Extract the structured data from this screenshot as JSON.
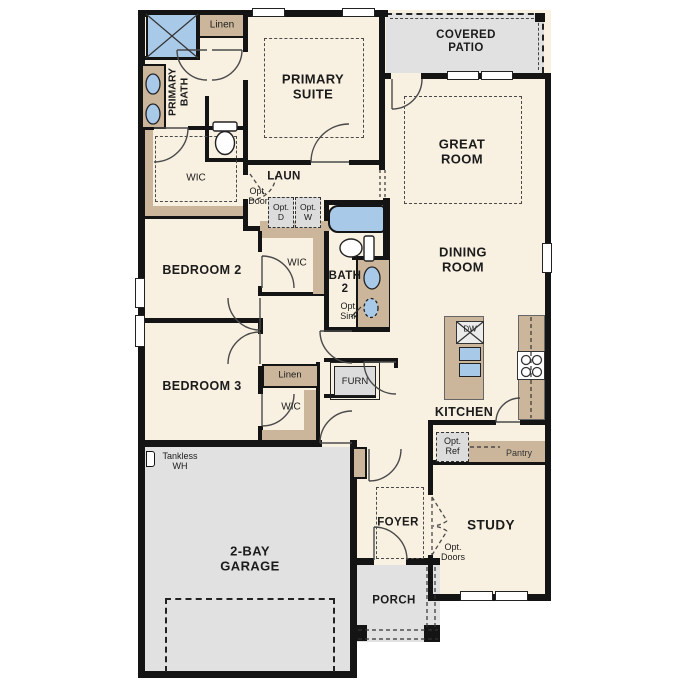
{
  "labels": {
    "covered_patio": "COVERED\nPATIO",
    "primary_suite": "PRIMARY\nSUITE",
    "primary_bath": "PRIMARY\nBATH",
    "linen_top": "Linen",
    "great_room": "GREAT\nROOM",
    "dining_room": "DINING\nROOM",
    "wic_primary": "WIC",
    "laundry": "LAUN",
    "opt_door": "Opt.\nDoor",
    "opt_dryer": "Opt.\nD",
    "opt_washer": "Opt.\nW",
    "bath2": "BATH\n2",
    "opt_sink": "Opt.\nSink",
    "bedroom2": "BEDROOM 2",
    "wic_bed2": "WIC",
    "bedroom3": "BEDROOM 3",
    "linen_hall": "Linen",
    "wic_bed3": "WIC",
    "furnace": "FURN",
    "kitchen": "KITCHEN",
    "dishwasher": "DW",
    "opt_ref": "Opt.\nRef",
    "pantry": "Pantry",
    "tankless_wh": "Tankless\nWH",
    "garage": "2-BAY\nGARAGE",
    "foyer": "FOYER",
    "study": "STUDY",
    "opt_doors": "Opt.\nDoors",
    "porch": "PORCH"
  },
  "colors": {
    "wall": "#141414",
    "floor": "#f8f0e1",
    "patio": "#e1e1e1",
    "casework": "#cbb69b",
    "fixture_blue": "#a9c9e9",
    "optional_fill": "#dcdcdc"
  }
}
